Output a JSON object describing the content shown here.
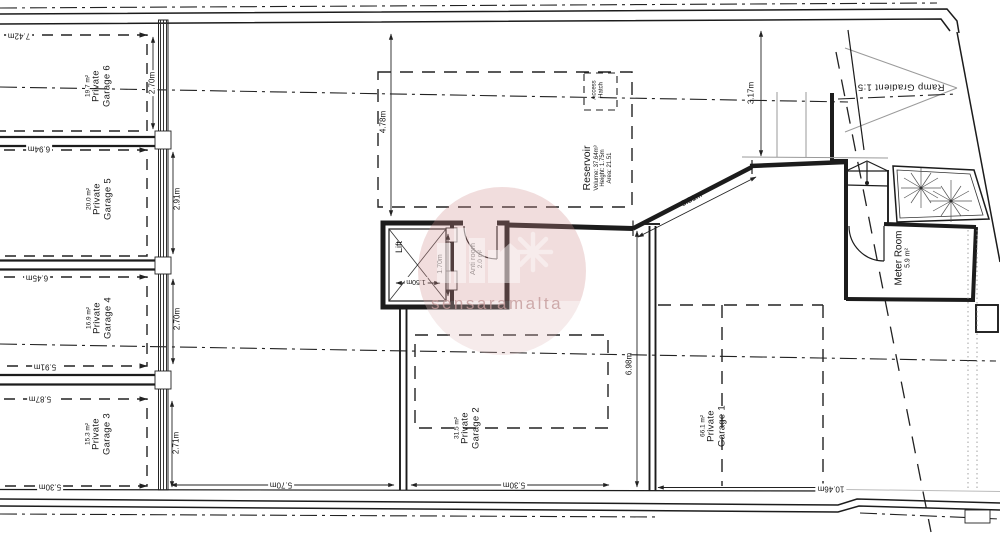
{
  "watermark": {
    "text": "sensaramalta"
  },
  "rooms": {
    "garage6": {
      "label": [
        "Private",
        "Garage 6"
      ],
      "area": "19.7 m²"
    },
    "garage5": {
      "label": [
        "Private",
        "Garage 5"
      ],
      "area": "20.0 m²"
    },
    "garage4": {
      "label": [
        "Private",
        "Garage 4"
      ],
      "area": "16.9 m²"
    },
    "garage3": {
      "label": [
        "Private",
        "Garage 3"
      ],
      "area": "15.3 m²"
    },
    "garage2": {
      "label": [
        "Private",
        "Garage 2"
      ],
      "area": "31.5 m²"
    },
    "garage1": {
      "label": [
        "Private",
        "Garage 1"
      ],
      "area": "66.1 m²"
    },
    "lift": {
      "label": "Lift"
    },
    "anti_room": {
      "label": "Anti room",
      "area": "2.0 m²"
    },
    "meter_room": {
      "label": "Meter Room",
      "area": "5.9 m²"
    },
    "reservoir": {
      "label": "Reservoir",
      "volume": "Volume: 37.64m³",
      "height": "Height: 1.75m",
      "area": "Area: 21.51"
    },
    "access_hatch": {
      "label": [
        "Access",
        "Hatch"
      ]
    },
    "ramp": {
      "label": "Ramp Gradient 1:5"
    }
  },
  "dimensions": {
    "garage6_width": "7.42m",
    "garage6_depth": "2.70m",
    "garage5_width": "6.94m",
    "garage5_depth": "2.91m",
    "garage4_width": "6.45m",
    "garage4_depth": "2.70m",
    "garage4_width_bottom": "5.91m",
    "garage3_width": "5.87m",
    "garage3_depth": "2.71m",
    "garage3_width_bottom": "5.30m",
    "driveway_depth": "4.78m",
    "ramp_width": "3.17m",
    "splayed_wall": "3.31m",
    "lift_width": "1.50m",
    "lift_depth": "1.70m",
    "left_bay_width": "5.70m",
    "garage2_width": "5.30m",
    "garage2_depth": "6.98m",
    "garage1_width": "10.46m"
  }
}
